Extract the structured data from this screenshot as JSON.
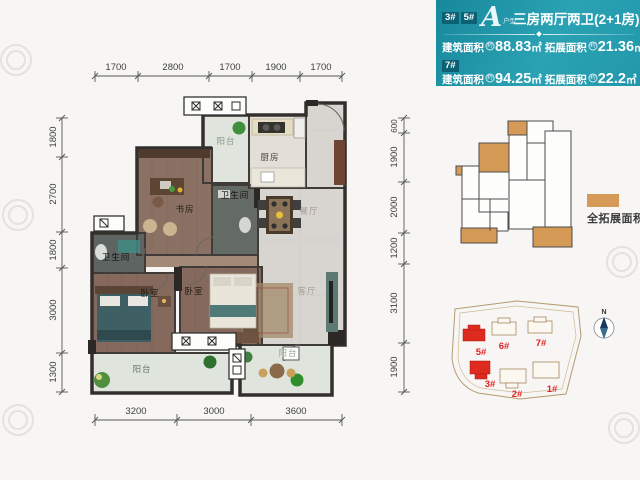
{
  "header": {
    "unit_badges": [
      "3#",
      "5#"
    ],
    "logo": "A",
    "logo_sub": "户型",
    "title": "三房两厅两卫(2+1房)",
    "badge_7": "7#",
    "area_rows": [
      {
        "build_label": "建筑面积",
        "approx": "约",
        "build_value": "88.83",
        "build_unit": "㎡",
        "expand_label": "拓展面积",
        "expand_value": "21.36",
        "expand_unit": "㎡"
      },
      {
        "build_label": "建筑面积",
        "approx": "约",
        "build_value": "94.25",
        "build_unit": "㎡",
        "expand_label": "拓展面积",
        "expand_value": "22.2",
        "expand_unit": "㎡"
      }
    ],
    "accent_color": "#17889b"
  },
  "floorplan": {
    "rooms": {
      "balcony_top": "阳台",
      "kitchen": "厨房",
      "bath1": "卫生间",
      "study": "书房",
      "dining": "餐厅",
      "living": "客厅",
      "bath2": "卫生间",
      "bedroom1": "卧室",
      "bedroom2": "卧室",
      "balcony_bl": "阳台",
      "balcony_bc": "阳台"
    },
    "dims": {
      "top": [
        "1700",
        "2800",
        "1700",
        "1900",
        "1700"
      ],
      "bottom": [
        "3200",
        "3000",
        "3600"
      ],
      "left": [
        "1800",
        "2700",
        "1800",
        "3000",
        "1300"
      ],
      "right": [
        "600",
        "1900",
        "2000",
        "1200",
        "3100",
        "1900"
      ]
    }
  },
  "expansion": {
    "legend_label": "全拓展面积",
    "legend_color": "#d59a55"
  },
  "siteplan": {
    "buildings": [
      "5#",
      "6#",
      "7#",
      "3#",
      "2#",
      "1#"
    ],
    "highlight_color": "#dd2b20",
    "compass": "N"
  }
}
